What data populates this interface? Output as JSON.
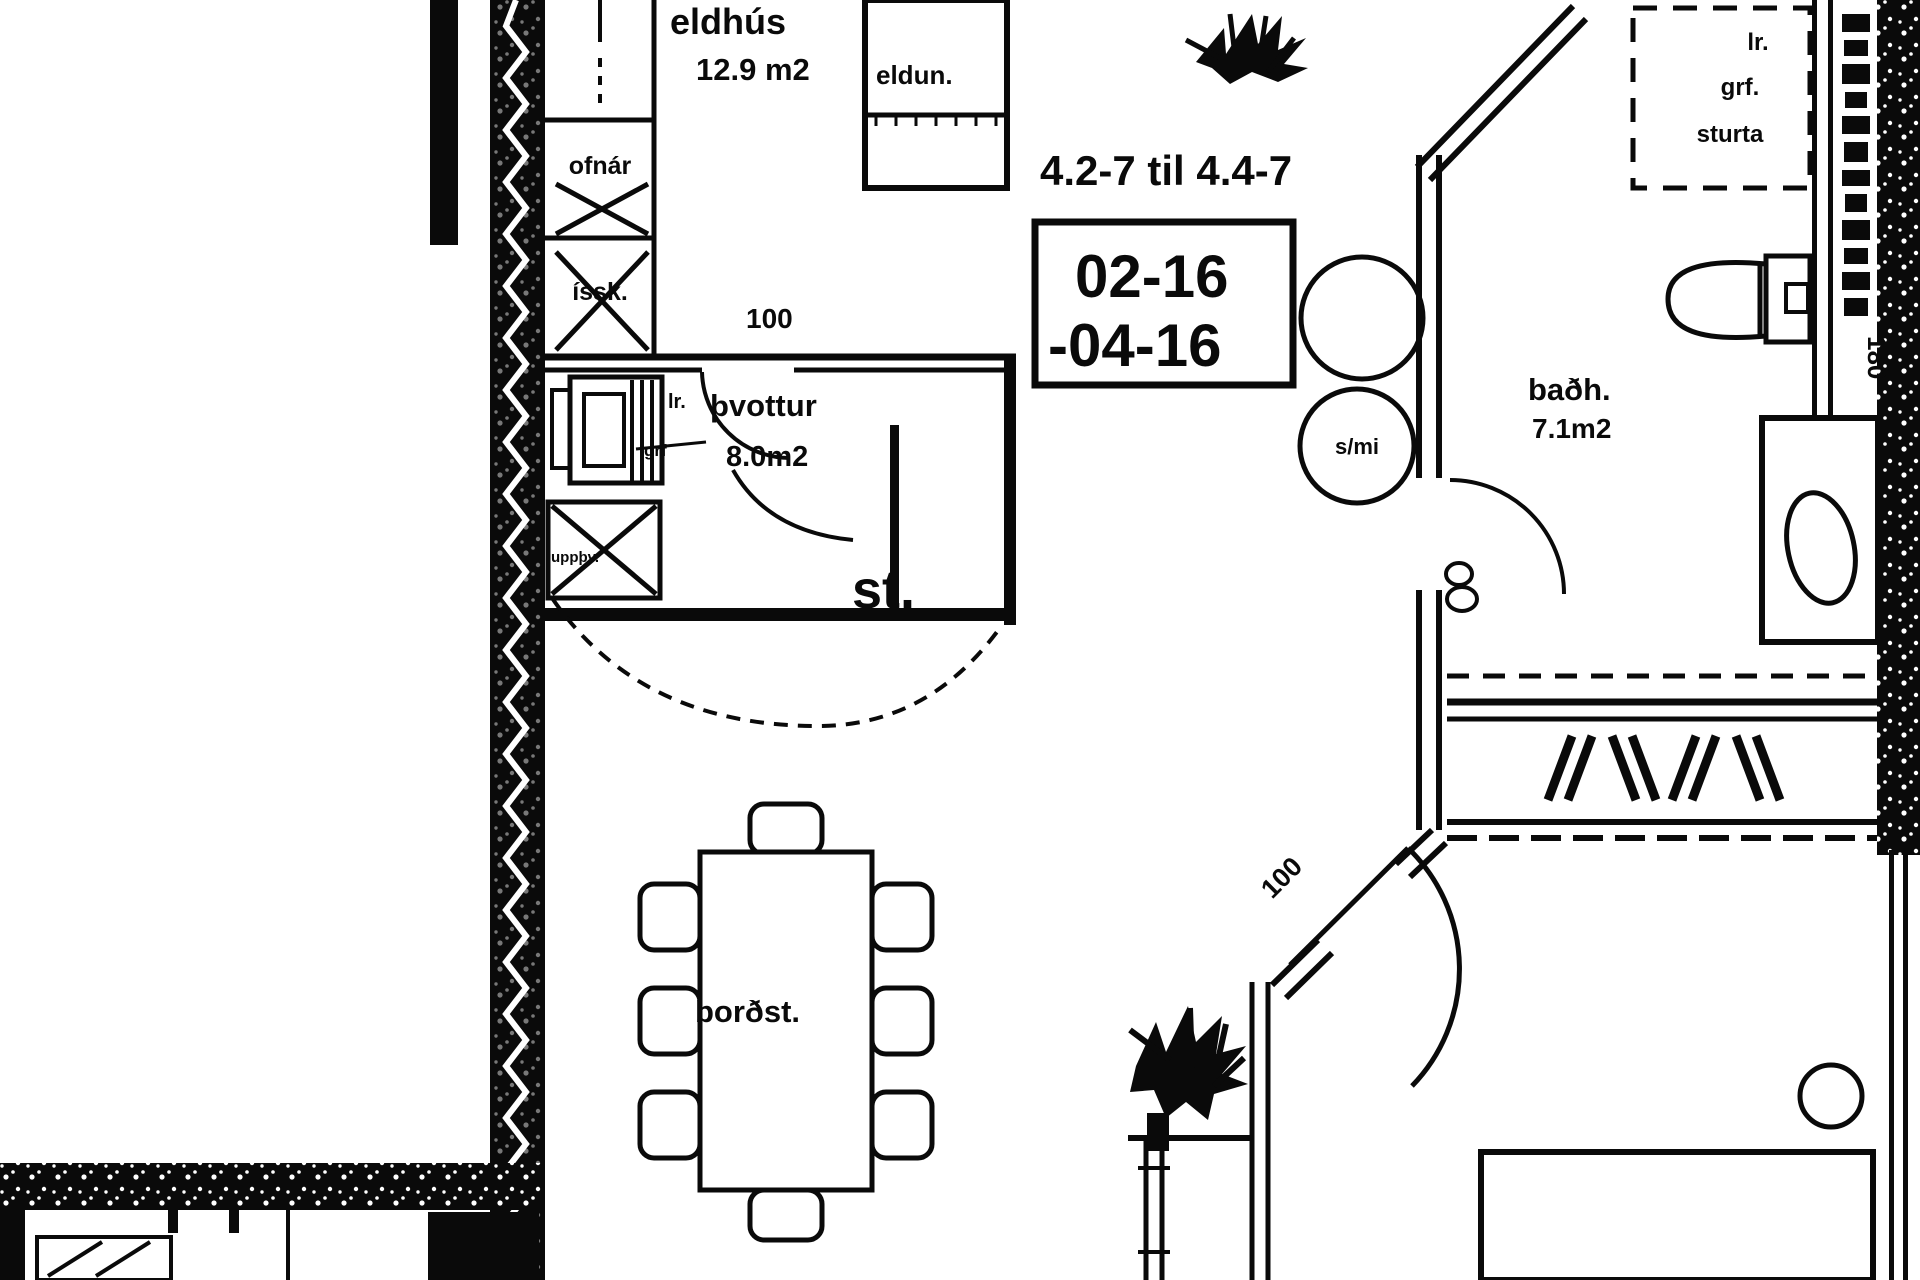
{
  "title": "apartment-floor-plan",
  "colors": {
    "ink": "#0a0a0a",
    "paper": "#ffffff"
  },
  "kitchen": {
    "name": "eldhús",
    "area": "12.9 m2",
    "stove": "eldun.",
    "oven": "ofnár",
    "fridge": "íssk."
  },
  "laundry": {
    "name": "þvottur",
    "area": "8.0m2",
    "drain_short": "lr.",
    "drain_abbr": "grf",
    "dishwasher": "uppþv.",
    "dim": "100"
  },
  "storage": {
    "label": "st."
  },
  "hall": {
    "range_text": "4.2-7 til 4.4-7",
    "unit_line1": "02-16",
    "unit_line2": "-04-16",
    "circle_label": "s/mi"
  },
  "bathroom": {
    "name": "baðh.",
    "area": "7.1m2",
    "shower_line1": "lr.",
    "shower_line2": "grf.",
    "shower_line3": "sturta",
    "side_strip": "180"
  },
  "dining": {
    "label": "borðst."
  },
  "bedroom": {
    "door_dim": "100"
  }
}
